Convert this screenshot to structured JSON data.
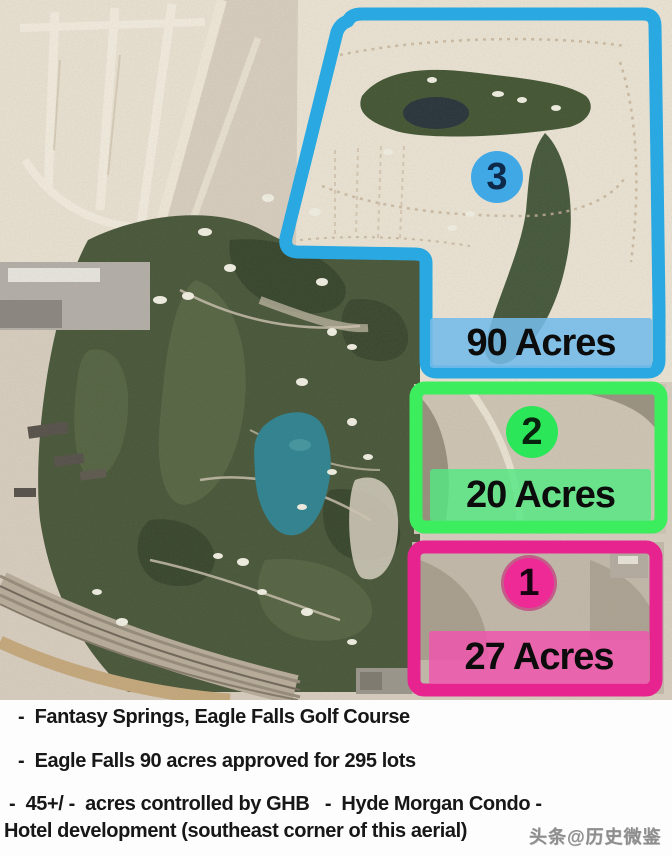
{
  "map": {
    "description_label": "aerial-photo-of-golf-course-and-parcels",
    "parcels": [
      {
        "number": "3",
        "acres_label": "90 Acres",
        "accent_color": "#29a8e1"
      },
      {
        "number": "2",
        "acres_label": "20 Acres",
        "accent_color": "#3cee5e"
      },
      {
        "number": "1",
        "acres_label": "27 Acres",
        "accent_color": "#e6238f"
      }
    ]
  },
  "notes": {
    "lines": [
      "-  Fantasy Springs, Eagle Falls Golf Course",
      "-  Eagle Falls 90 acres approved for 295 lots",
      "-  45+/ -  acres controlled by GHB   -  Hyde Morgan Condo -",
      "Hotel development (southeast corner of this aerial)"
    ]
  },
  "watermark": {
    "text": "头条@历史微鉴"
  }
}
